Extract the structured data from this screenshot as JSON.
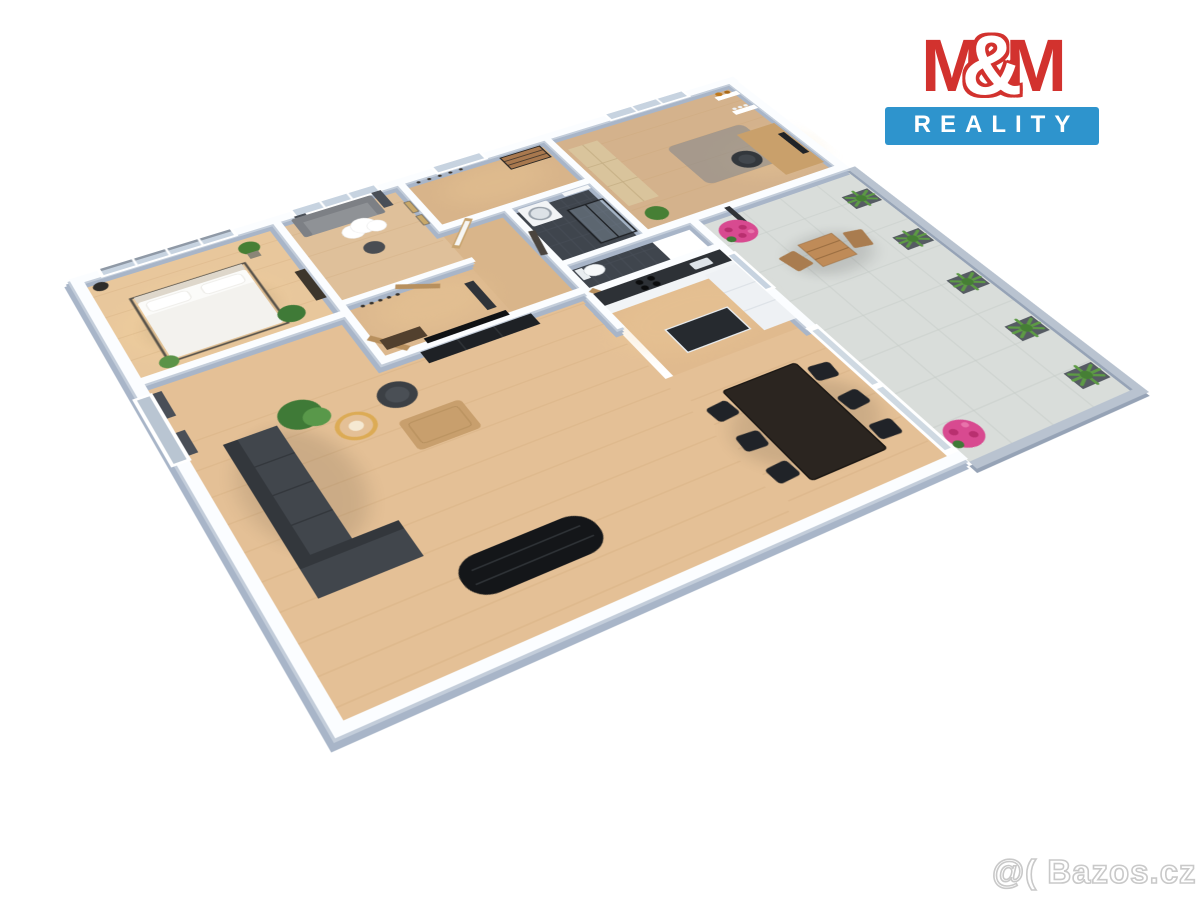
{
  "logo": {
    "m_left": "M",
    "ampersand": "&",
    "m_right": "M",
    "subtitle": "REALITY",
    "red": "#d2322e",
    "blue": "#2e94cd"
  },
  "watermark": {
    "text": "@( Bazos.cz",
    "color": "#c9c9c9"
  },
  "floorplan": {
    "view": "3d-top-down-apartment-render",
    "rooms": [
      {
        "name": "bedroom",
        "floor": "wood",
        "furniture": [
          "double-bed",
          "potted-plants",
          "pendant-lamp",
          "dresser",
          "window-with-roller-blind"
        ]
      },
      {
        "name": "kids-room",
        "floor": "wood",
        "furniture": [
          "gray-sofa",
          "cloud-pendant-lamp",
          "side-table",
          "dark-curtains",
          "wall-art"
        ]
      },
      {
        "name": "entry-hall",
        "floor": "wood",
        "furniture": [
          "bench",
          "coat-hooks",
          "window"
        ]
      },
      {
        "name": "hallway",
        "floor": "wood",
        "furniture": [
          "console-table",
          "coat-hooks",
          "standing-mirror",
          "wooden-doors",
          "open-door"
        ]
      },
      {
        "name": "bathroom",
        "floor": "dark-tile",
        "furniture": [
          "washing-machine",
          "glass-shower",
          "wall-shelf"
        ]
      },
      {
        "name": "wc",
        "floor": "dark-tile",
        "furniture": [
          "toilet"
        ]
      },
      {
        "name": "study",
        "floor": "wood",
        "furniture": [
          "tall-wardrobe",
          "desk",
          "monitor",
          "office-chair",
          "rug",
          "wall-shelves-with-bottles-and-glasses",
          "plant"
        ]
      },
      {
        "name": "kitchen",
        "floor": "wood",
        "furniture": [
          "counter-with-dark-top",
          "cooktop",
          "sink",
          "tall-white-cabinets",
          "island"
        ]
      },
      {
        "name": "living-room",
        "floor": "wood",
        "furniture": [
          "l-shaped-dark-sofa",
          "coffee-table",
          "rattan-floor-lamp",
          "palm-plant",
          "armchair",
          "wall-tv",
          "tv-bench",
          "black-shelf-unit",
          "dining-table",
          "six-black-chairs",
          "glass-doors-to-terrace",
          "window-with-curtain"
        ]
      },
      {
        "name": "terrace",
        "floor": "gray-tile",
        "furniture": [
          "outdoor-wood-table",
          "outdoor-chairs",
          "agave-planters",
          "pink-flower-bushes",
          "parapet"
        ]
      }
    ],
    "palette": {
      "wall_top": "#fbfdff",
      "wall_side": "#a8b5c8",
      "wood_floor": "#e2bd92",
      "dark_tile": "#3f454d",
      "terrace_tile": "#d9ddda",
      "sofa_dark": "#41464c",
      "black_furniture": "#1e2125",
      "rattan": "#dcab55",
      "plant_green": "#467f35",
      "flower_pink": "#d84a90",
      "outdoor_wood": "#bf8b58",
      "door_wood": "#b8905e"
    }
  }
}
